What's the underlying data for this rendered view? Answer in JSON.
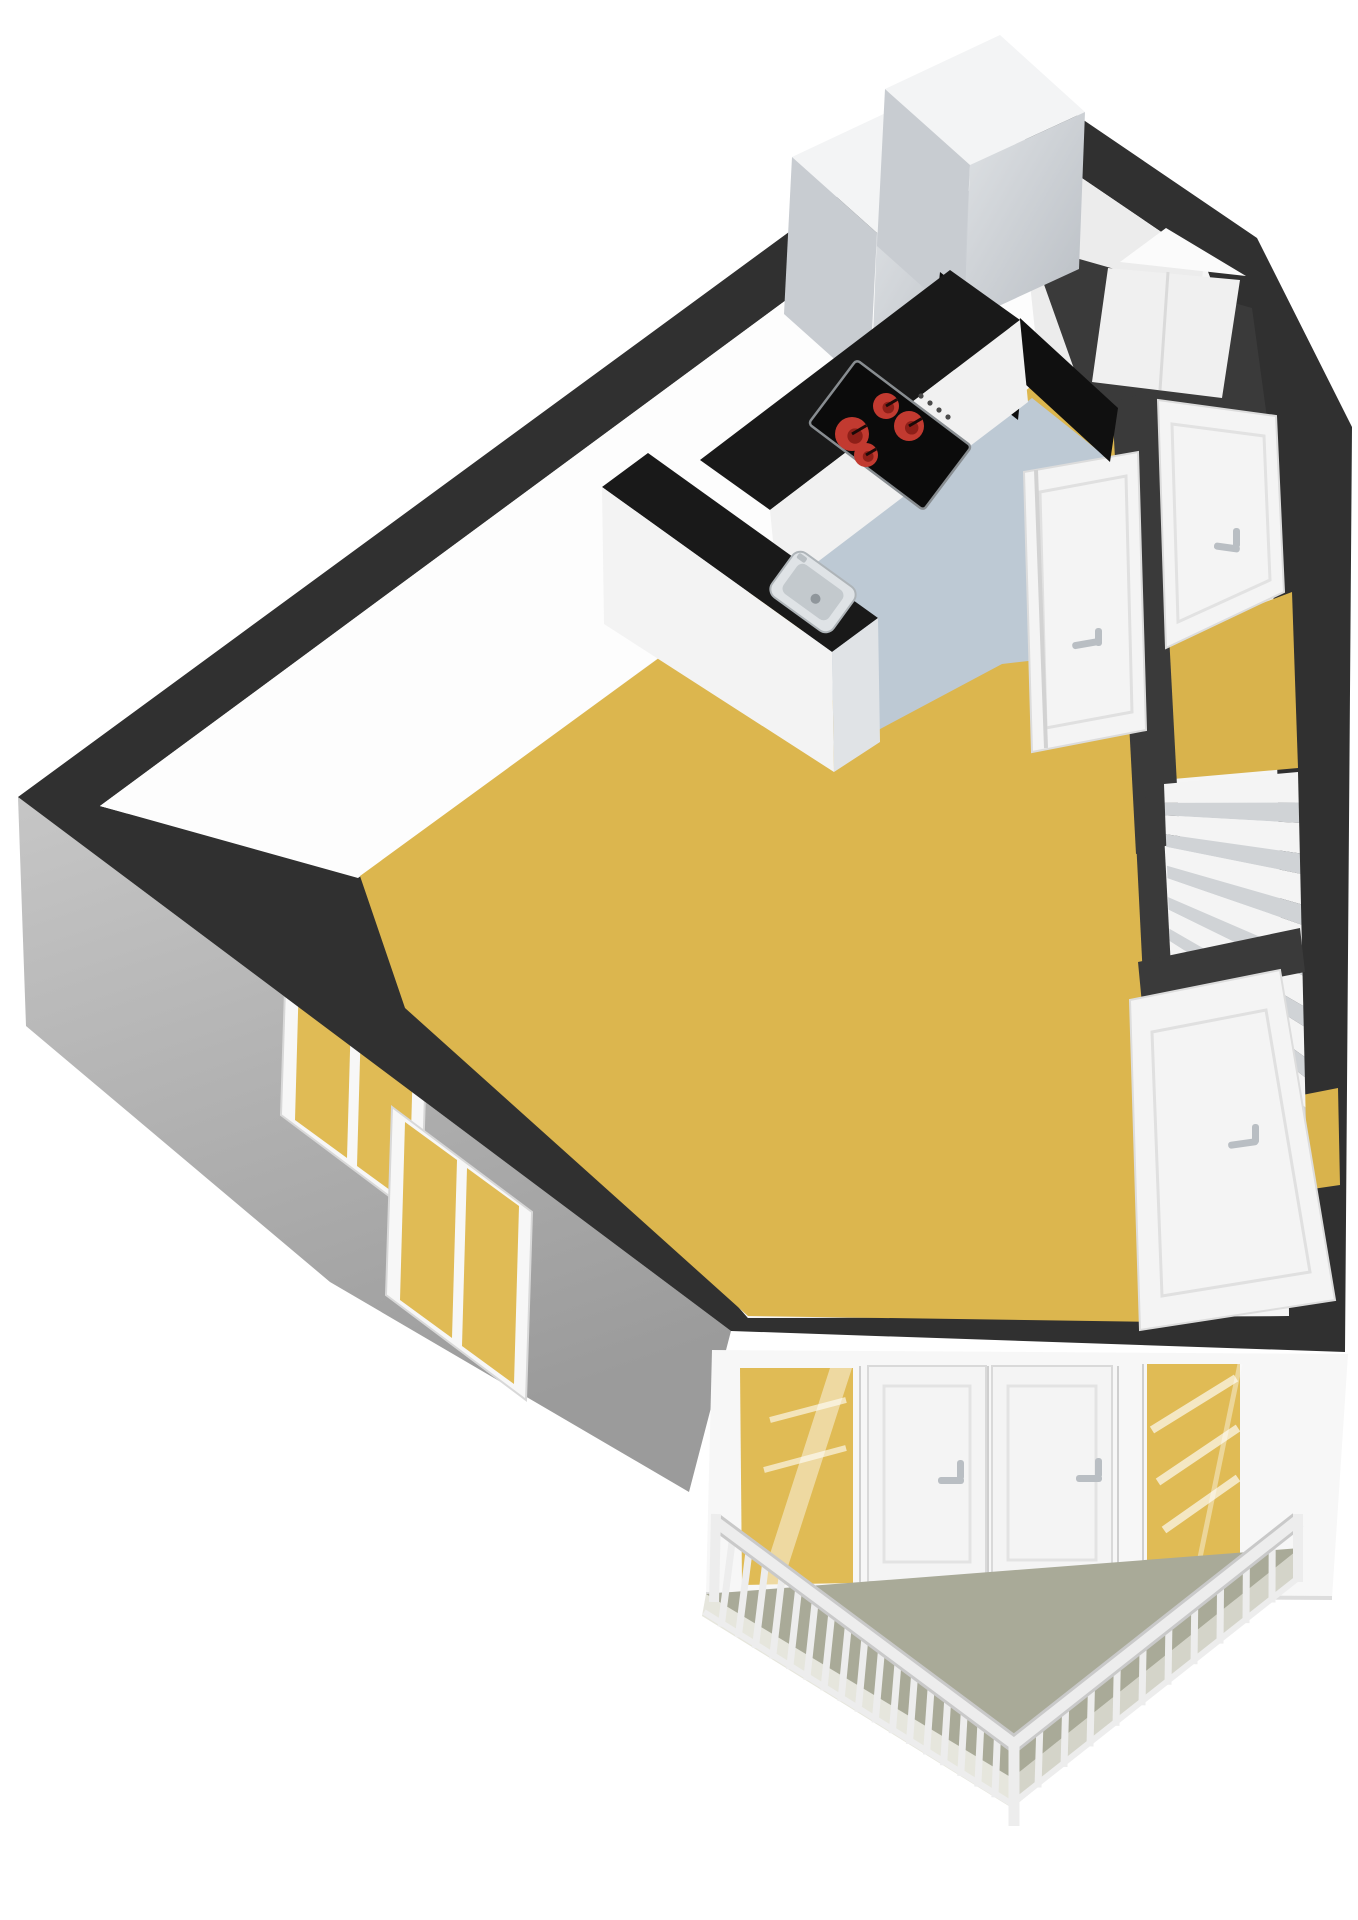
{
  "meta": {
    "kind": "3d-floorplan-render",
    "visible_text": "",
    "view": "isometric-top-down apartment floor"
  },
  "colors": {
    "page_bg": "#ffffff",
    "wall_top": "#303030",
    "wall_top_inner": "#3a3a3a",
    "wall_interior": "#f5f5f5",
    "wall_interior_bright": "#fdfdfd",
    "wall_interior_shade": "#ececec",
    "wall_exterior_light": "#c6c6c6",
    "wall_exterior": "#9b9b9b",
    "floor_living": "#dcb64e",
    "floor_kitchen": "#bdc9d4",
    "floor_hall": "#d9b34c",
    "floor_balcony": "#a9aa98",
    "balcony_slab_light": "#e6e6dd",
    "balcony_slab_dark": "#d4d4c9",
    "counter": "#191919",
    "counter_dark": "#101010",
    "appliance": "#0d0d0d",
    "cabinet_top": "#f3f4f5",
    "cabinet_side": "#c8ccd1",
    "cabinet_front": "#e2e5e8",
    "stove": "#0b0b0b",
    "stove_rim": "#8a8f93",
    "burner_red": "#c23a30",
    "burner_dark": "#8e1f18",
    "burner_pointer": "#1a0a08",
    "sink_outer": "#dfe3e6",
    "sink_inner": "#c3c9cd",
    "sink_drain": "#8f969b",
    "door_white": "#f4f4f4",
    "door_frame": "#d6d6d6",
    "handle_gray": "#b9bec3",
    "glass_yellow": "#e0bb55",
    "glass_reflection": "#ffffff",
    "window_frame": "#f7f7f7",
    "railing_white": "#ededed",
    "railing_shadow": "#c9c9c9",
    "stair_tread": "#f4f4f4",
    "stair_riser": "#d0d3d6"
  },
  "scene": {
    "rooms": [
      {
        "name": "living-room",
        "floor_color": "floor_living"
      },
      {
        "name": "kitchen",
        "floor_color": "floor_kitchen"
      },
      {
        "name": "hallway",
        "floor_color": "floor_hall"
      },
      {
        "name": "stairwell",
        "floor_color": "stair_tread"
      },
      {
        "name": "closet-niche",
        "floor_color": "wall_interior"
      },
      {
        "name": "balcony",
        "floor_color": "floor_balcony"
      }
    ],
    "fixtures": [
      {
        "name": "cooktop",
        "burners": 4
      },
      {
        "name": "kitchen-sink",
        "count": 1
      },
      {
        "name": "tall-cabinets",
        "count": 2
      },
      {
        "name": "kitchen-peninsula",
        "count": 1
      },
      {
        "name": "interior-doors",
        "count": 3
      },
      {
        "name": "entrance-door",
        "count": 1
      },
      {
        "name": "balcony-doors",
        "count": 2
      },
      {
        "name": "balcony-glass-panels",
        "count": 2
      },
      {
        "name": "windows",
        "count": 2
      },
      {
        "name": "stair-treads",
        "count": 7
      },
      {
        "name": "railing-pickets-left",
        "count": 18
      },
      {
        "name": "railing-pickets-right",
        "count": 11
      }
    ]
  }
}
